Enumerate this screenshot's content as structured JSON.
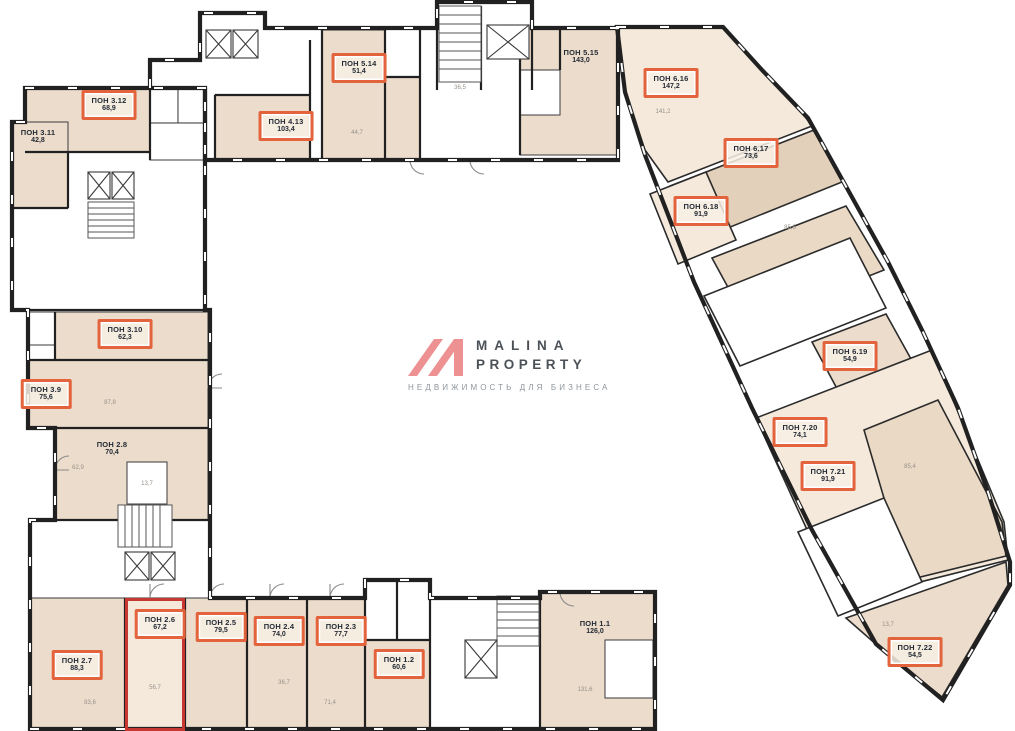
{
  "watermark": {
    "brand_line1": "MALINA",
    "brand_line2": "PROPERTY",
    "tagline": "НЕДВИЖИМОСТЬ ДЛЯ БИЗНЕСА"
  },
  "colors": {
    "accent_orange": "#e2633c",
    "selection_red": "#c63831",
    "room_beige": "#ecdccb",
    "room_beige_light": "#f4e9db",
    "room_beige_dark": "#e3d0ba",
    "room_beige_mid": "#ead9c5",
    "wall_dark": "#212121",
    "thin_line": "#4a4a4a",
    "logo_pink": "#ed9193",
    "brand_text": "#4b5157",
    "tagline_gray": "#8e959c"
  },
  "units": [
    {
      "name": "ПОН 3.12",
      "area": "68,9",
      "x": 109,
      "y": 105,
      "boxed": true,
      "selected": false
    },
    {
      "name": "ПОН 3.11",
      "area": "42,8",
      "x": 38,
      "y": 137,
      "boxed": false,
      "selected": false
    },
    {
      "name": "ПОН 4.13",
      "area": "103,4",
      "x": 286,
      "y": 126,
      "boxed": true,
      "selected": false
    },
    {
      "name": "ПОН 5.14",
      "area": "51,4",
      "x": 359,
      "y": 68,
      "boxed": true,
      "selected": false
    },
    {
      "name": "ПОН 5.15",
      "area": "143,0",
      "x": 581,
      "y": 57,
      "boxed": false,
      "selected": false
    },
    {
      "name": "ПОН 6.16",
      "area": "147,2",
      "x": 671,
      "y": 83,
      "boxed": true,
      "selected": false
    },
    {
      "name": "ПОН 6.17",
      "area": "73,6",
      "x": 751,
      "y": 153,
      "boxed": true,
      "selected": false
    },
    {
      "name": "ПОН 6.18",
      "area": "91,9",
      "x": 701,
      "y": 211,
      "boxed": true,
      "selected": false
    },
    {
      "name": "ПОН 3.10",
      "area": "62,3",
      "x": 125,
      "y": 334,
      "boxed": true,
      "selected": false
    },
    {
      "name": "ПОН 3.9",
      "area": "75,6",
      "x": 46,
      "y": 394,
      "boxed": true,
      "selected": false
    },
    {
      "name": "ПОН 2.8",
      "area": "70,4",
      "x": 112,
      "y": 449,
      "boxed": false,
      "selected": false
    },
    {
      "name": "ПОН 6.19",
      "area": "54,9",
      "x": 850,
      "y": 356,
      "boxed": true,
      "selected": false
    },
    {
      "name": "ПОН 7.20",
      "area": "74,1",
      "x": 800,
      "y": 432,
      "boxed": true,
      "selected": false
    },
    {
      "name": "ПОН 7.21",
      "area": "91,9",
      "x": 828,
      "y": 476,
      "boxed": true,
      "selected": false
    },
    {
      "name": "ПОН 7.22",
      "area": "54,5",
      "x": 915,
      "y": 652,
      "boxed": true,
      "selected": false
    },
    {
      "name": "ПОН 2.7",
      "area": "88,3",
      "x": 77,
      "y": 665,
      "boxed": true,
      "selected": false
    },
    {
      "name": "ПОН 2.6",
      "area": "67,2",
      "x": 160,
      "y": 624,
      "boxed": true,
      "selected": true
    },
    {
      "name": "ПОН 2.5",
      "area": "79,5",
      "x": 221,
      "y": 627,
      "boxed": true,
      "selected": false
    },
    {
      "name": "ПОН 2.4",
      "area": "74,0",
      "x": 279,
      "y": 631,
      "boxed": true,
      "selected": false
    },
    {
      "name": "ПОН 2.3",
      "area": "77,7",
      "x": 341,
      "y": 631,
      "boxed": true,
      "selected": false
    },
    {
      "name": "ПОН 1.2",
      "area": "60,6",
      "x": 399,
      "y": 664,
      "boxed": true,
      "selected": false
    },
    {
      "name": "ПОН 1.1",
      "area": "126,0",
      "x": 595,
      "y": 628,
      "boxed": false,
      "selected": false
    }
  ],
  "annotations": [
    {
      "text": "44,7",
      "x": 357,
      "y": 133
    },
    {
      "text": "36,5",
      "x": 460,
      "y": 88
    },
    {
      "text": "141,2",
      "x": 663,
      "y": 112
    },
    {
      "text": "85,6",
      "x": 790,
      "y": 228
    },
    {
      "text": "87,8",
      "x": 110,
      "y": 403
    },
    {
      "text": "62,9",
      "x": 78,
      "y": 468
    },
    {
      "text": "13,7",
      "x": 147,
      "y": 484
    },
    {
      "text": "85,4",
      "x": 910,
      "y": 467
    },
    {
      "text": "13,7",
      "x": 888,
      "y": 625
    },
    {
      "text": "56,7",
      "x": 155,
      "y": 688
    },
    {
      "text": "83,6",
      "x": 90,
      "y": 703
    },
    {
      "text": "36,7",
      "x": 284,
      "y": 683
    },
    {
      "text": "71,4",
      "x": 330,
      "y": 703
    },
    {
      "text": "131,6",
      "x": 585,
      "y": 690
    }
  ]
}
